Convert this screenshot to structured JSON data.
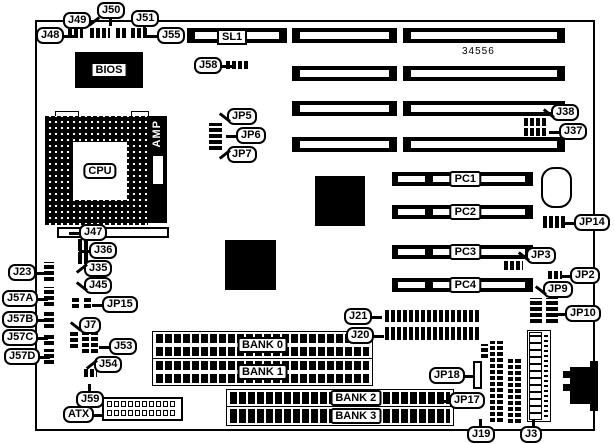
{
  "board": {
    "part_number": "34556"
  },
  "chips": {
    "bios": "BIOS",
    "cpu": "CPU",
    "amp": "AMP"
  },
  "slots": {
    "sl1": "SL1",
    "pci": [
      "PC1",
      "PC2",
      "PC3",
      "PC4"
    ],
    "memory_banks": [
      "BANK 0",
      "BANK 1",
      "BANK 2",
      "BANK 3"
    ]
  },
  "callouts": [
    {
      "label": "J48",
      "x": 36,
      "y": 27,
      "tail": "right"
    },
    {
      "label": "J49",
      "x": 63,
      "y": 12,
      "tail": "down-right"
    },
    {
      "label": "J50",
      "x": 97,
      "y": 2,
      "tail": "down"
    },
    {
      "label": "J51",
      "x": 131,
      "y": 10,
      "tail": "down"
    },
    {
      "label": "J55",
      "x": 157,
      "y": 27,
      "tail": "left"
    },
    {
      "label": "J58",
      "x": 194,
      "y": 57,
      "tail": "right"
    },
    {
      "label": "JP5",
      "x": 227,
      "y": 108,
      "tail": "down-left"
    },
    {
      "label": "JP6",
      "x": 236,
      "y": 127,
      "tail": "left"
    },
    {
      "label": "JP7",
      "x": 227,
      "y": 146,
      "tail": "up-left"
    },
    {
      "label": "J38",
      "x": 551,
      "y": 104,
      "tail": "down-left"
    },
    {
      "label": "J37",
      "x": 559,
      "y": 123,
      "tail": "left"
    },
    {
      "label": "JP14",
      "x": 574,
      "y": 214,
      "tail": "left"
    },
    {
      "label": "JP3",
      "x": 526,
      "y": 247,
      "tail": "down-left"
    },
    {
      "label": "JP2",
      "x": 570,
      "y": 267,
      "tail": "left"
    },
    {
      "label": "JP9",
      "x": 543,
      "y": 281,
      "tail": "down-left"
    },
    {
      "label": "JP10",
      "x": 565,
      "y": 305,
      "tail": "left"
    },
    {
      "label": "J47",
      "x": 79,
      "y": 224,
      "tail": "left"
    },
    {
      "label": "J36",
      "x": 89,
      "y": 242,
      "tail": "left"
    },
    {
      "label": "J35",
      "x": 84,
      "y": 260,
      "tail": "up-left"
    },
    {
      "label": "J23",
      "x": 8,
      "y": 264,
      "tail": "right"
    },
    {
      "label": "J45",
      "x": 84,
      "y": 277,
      "tail": "down-left"
    },
    {
      "label": "JP15",
      "x": 102,
      "y": 296,
      "tail": "left"
    },
    {
      "label": "J57A",
      "x": 2,
      "y": 290,
      "tail": "right"
    },
    {
      "label": "J57B",
      "x": 2,
      "y": 311,
      "tail": "right"
    },
    {
      "label": "J57C",
      "x": 2,
      "y": 329,
      "tail": "right"
    },
    {
      "label": "J57D",
      "x": 4,
      "y": 348,
      "tail": "right"
    },
    {
      "label": "J7",
      "x": 79,
      "y": 317,
      "tail": "down-left"
    },
    {
      "label": "J53",
      "x": 109,
      "y": 338,
      "tail": "left"
    },
    {
      "label": "J54",
      "x": 94,
      "y": 356,
      "tail": "up-left"
    },
    {
      "label": "J59",
      "x": 76,
      "y": 391,
      "tail": "up"
    },
    {
      "label": "ATX",
      "x": 63,
      "y": 406,
      "tail": "right"
    },
    {
      "label": "J21",
      "x": 344,
      "y": 308,
      "tail": "right"
    },
    {
      "label": "J20",
      "x": 346,
      "y": 327,
      "tail": "right"
    },
    {
      "label": "JP18",
      "x": 429,
      "y": 367,
      "tail": "right"
    },
    {
      "label": "JP17",
      "x": 449,
      "y": 392,
      "tail": "left"
    },
    {
      "label": "J19",
      "x": 467,
      "y": 426,
      "tail": "up"
    },
    {
      "label": "J3",
      "x": 520,
      "y": 426,
      "tail": "up"
    }
  ]
}
